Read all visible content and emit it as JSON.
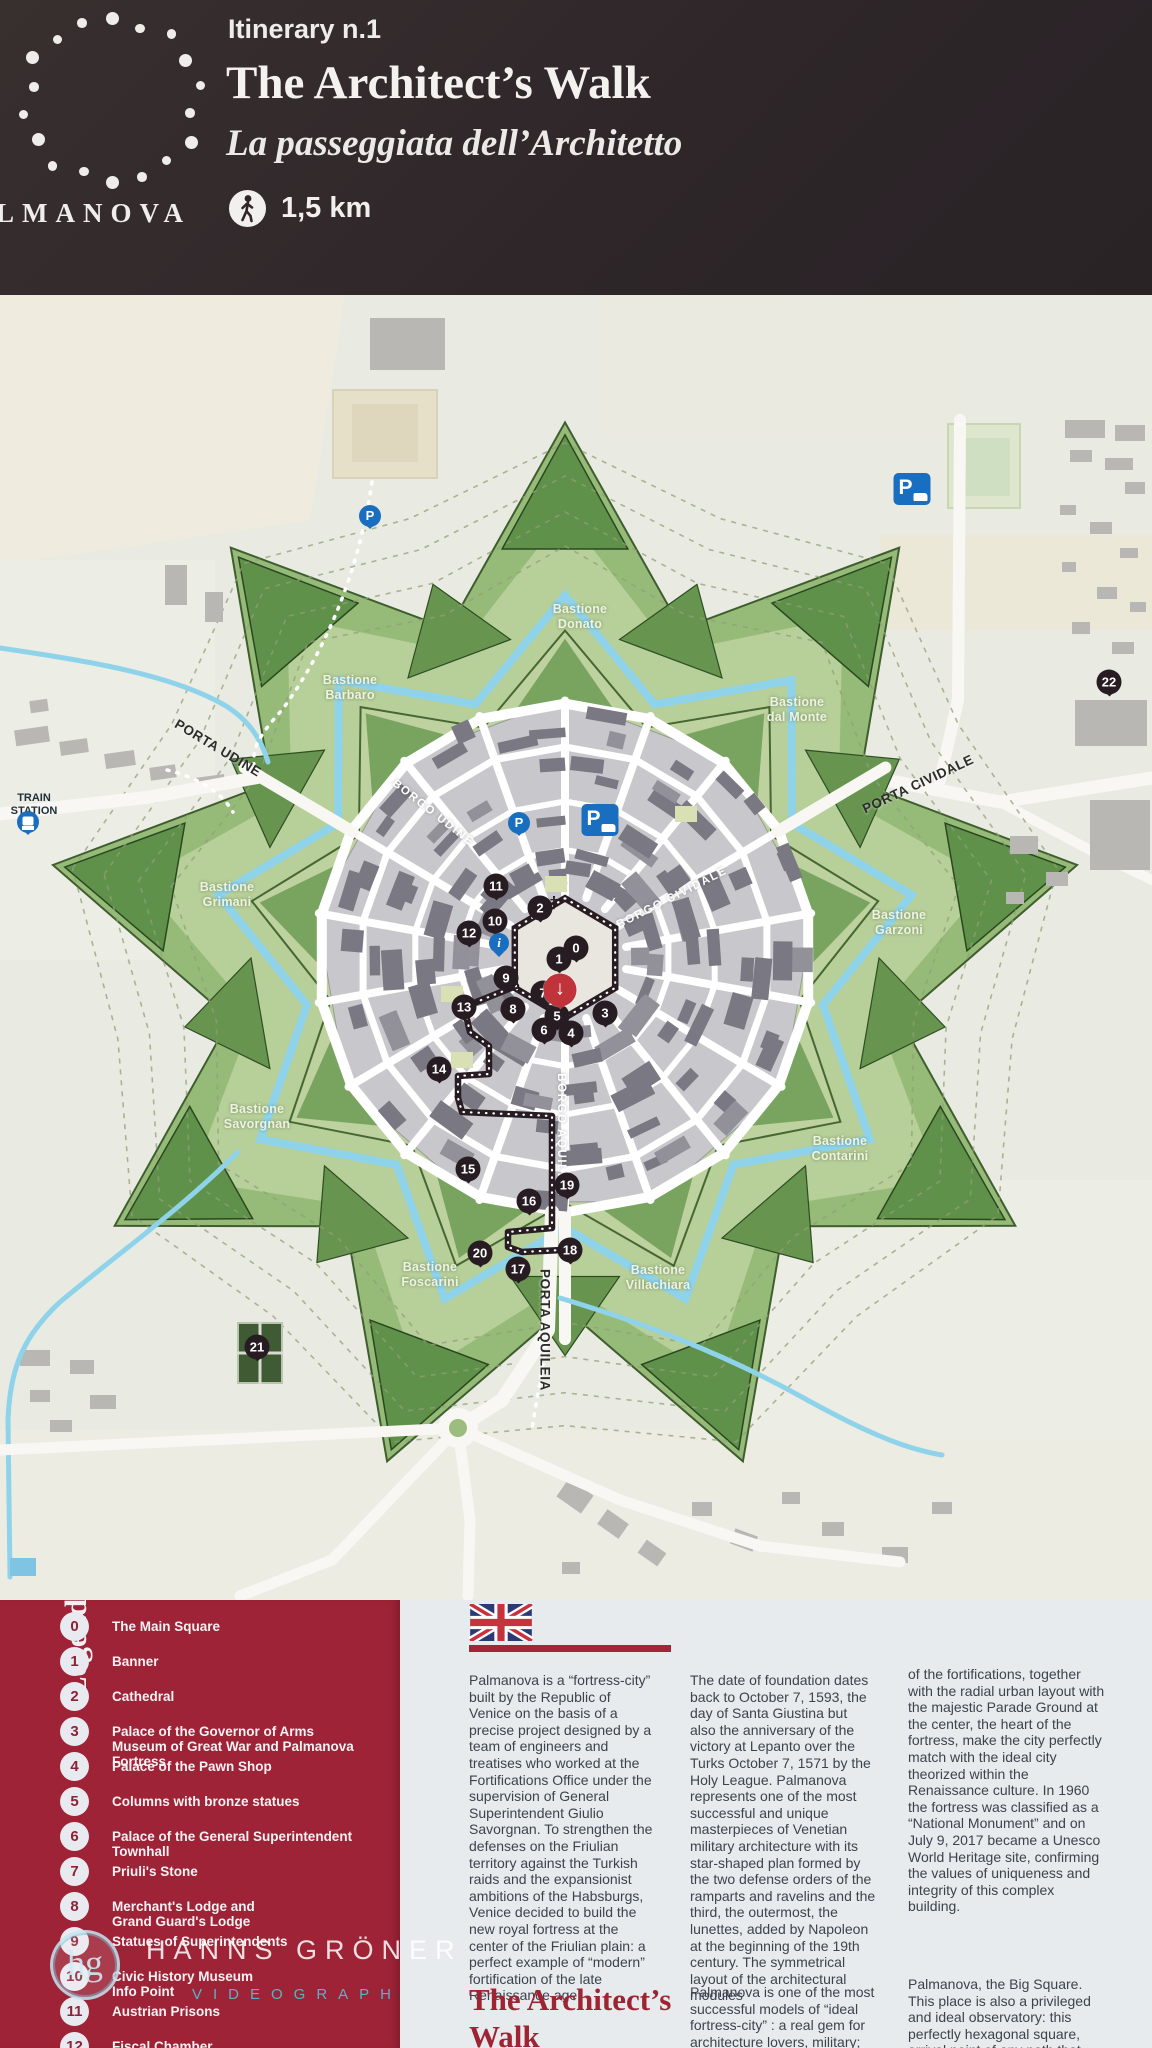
{
  "header": {
    "itinerary": "Itinerary n.1",
    "title": "The Architect’s Walk",
    "subtitle": "La passeggiata dell’Architetto",
    "distance": "1,5 km",
    "brand": "LMANOVA"
  },
  "map": {
    "train_station": "TRAIN\nSTATION",
    "bastions": [
      {
        "label": "Bastione\nDonato",
        "x": 580,
        "y": 617
      },
      {
        "label": "Bastione\nBarbaro",
        "x": 350,
        "y": 688
      },
      {
        "label": "Bastione\ndal Monte",
        "x": 797,
        "y": 710
      },
      {
        "label": "Bastione\nGrimani",
        "x": 227,
        "y": 895
      },
      {
        "label": "Bastione\nGarzoni",
        "x": 899,
        "y": 923
      },
      {
        "label": "Bastione\nSavorgnan",
        "x": 257,
        "y": 1117
      },
      {
        "label": "Bastione\nContarini",
        "x": 840,
        "y": 1149
      },
      {
        "label": "Bastione\nFoscarini",
        "x": 430,
        "y": 1275
      },
      {
        "label": "Bastione\nVillachiara",
        "x": 658,
        "y": 1278
      }
    ],
    "gates": [
      {
        "label": "PORTA UDINE",
        "x": 218,
        "y": 748,
        "rot": 31
      },
      {
        "label": "PORTA CIVIDALE",
        "x": 918,
        "y": 784,
        "rot": -25
      },
      {
        "label": "PORTA AQUILEIA",
        "x": 545,
        "y": 1330,
        "rot": 90
      }
    ],
    "streets": [
      {
        "label": "BORGO UDINE",
        "x": 433,
        "y": 813,
        "rot": 38
      },
      {
        "label": "BORGO CIVIDALE",
        "x": 672,
        "y": 898,
        "rot": -27
      },
      {
        "label": "BORGO AQUILEIA",
        "x": 561,
        "y": 1135,
        "rot": 90
      }
    ],
    "markers": [
      {
        "id": "0",
        "type": "num",
        "x": 576,
        "y": 948
      },
      {
        "id": "1",
        "type": "num",
        "x": 559,
        "y": 959
      },
      {
        "id": "2",
        "type": "num",
        "x": 540,
        "y": 908
      },
      {
        "id": "3",
        "type": "num",
        "x": 605,
        "y": 1013
      },
      {
        "id": "4",
        "type": "num",
        "x": 571,
        "y": 1033
      },
      {
        "id": "5",
        "type": "num",
        "x": 557,
        "y": 1016
      },
      {
        "id": "6",
        "type": "num",
        "x": 544,
        "y": 1030
      },
      {
        "id": "7",
        "type": "num",
        "x": 543,
        "y": 993
      },
      {
        "id": "8",
        "type": "num",
        "x": 513,
        "y": 1009
      },
      {
        "id": "9",
        "type": "num",
        "x": 506,
        "y": 978
      },
      {
        "id": "10",
        "type": "num",
        "x": 495,
        "y": 921
      },
      {
        "id": "11",
        "type": "num",
        "x": 496,
        "y": 886
      },
      {
        "id": "12",
        "type": "num",
        "x": 469,
        "y": 933
      },
      {
        "id": "13",
        "type": "num",
        "x": 464,
        "y": 1007
      },
      {
        "id": "14",
        "type": "num",
        "x": 439,
        "y": 1069
      },
      {
        "id": "15",
        "type": "num",
        "x": 468,
        "y": 1169
      },
      {
        "id": "16",
        "type": "num",
        "x": 529,
        "y": 1201
      },
      {
        "id": "17",
        "type": "num",
        "x": 518,
        "y": 1269
      },
      {
        "id": "18",
        "type": "num",
        "x": 570,
        "y": 1250
      },
      {
        "id": "19",
        "type": "num",
        "x": 567,
        "y": 1185
      },
      {
        "id": "20",
        "type": "num",
        "x": 480,
        "y": 1253
      },
      {
        "id": "21",
        "type": "num",
        "x": 257,
        "y": 1347
      },
      {
        "id": "22",
        "type": "num",
        "x": 1109,
        "y": 682
      },
      {
        "id": "P",
        "type": "p-circle",
        "x": 370,
        "y": 516
      },
      {
        "id": "P",
        "type": "p-sign",
        "x": 912,
        "y": 489
      },
      {
        "id": "P",
        "type": "p-circle",
        "x": 519,
        "y": 823
      },
      {
        "id": "P",
        "type": "p-sign",
        "x": 600,
        "y": 820
      },
      {
        "id": "i",
        "type": "info",
        "x": 499,
        "y": 943
      },
      {
        "id": "↓",
        "type": "here",
        "x": 560,
        "y": 990
      },
      {
        "id": "",
        "type": "train",
        "x": 28,
        "y": 822
      },
      {
        "id": "†",
        "type": "cross",
        "x": 554,
        "y": 903
      }
    ],
    "scale": {
      "values": [
        "0",
        "100",
        "200",
        "300",
        "400"
      ]
    }
  },
  "legend": {
    "title": "Legend",
    "items": [
      {
        "num": "0",
        "label": "The Main Square"
      },
      {
        "num": "1",
        "label": "Banner"
      },
      {
        "num": "2",
        "label": "Cathedral"
      },
      {
        "num": "3",
        "label": "Palace of the Governor of Arms\nMuseum of Great War and Palmanova Fortress"
      },
      {
        "num": "4",
        "label": "Palace of the Pawn Shop"
      },
      {
        "num": "5",
        "label": "Columns with bronze statues"
      },
      {
        "num": "6",
        "label": "Palace of the General Superintendent\nTownhall"
      },
      {
        "num": "7",
        "label": "Priuli's Stone"
      },
      {
        "num": "8",
        "label": "Merchant's Lodge and\nGrand Guard's Lodge"
      },
      {
        "num": "9",
        "label": "Statues of Superintendents"
      },
      {
        "num": "10",
        "label": "Civic History Museum\nInfo Point"
      },
      {
        "num": "11",
        "label": "Austrian Prisons"
      },
      {
        "num": "12",
        "label": "Fiscal Chamber"
      }
    ]
  },
  "info": {
    "col1": "Palmanova is a “fortress-city” built by the Republic of Venice on the basis of a precise project designed by a team of engineers and treatises who worked at the Fortifications Office under the supervision of General Superintendent Giulio Savorgnan. To strengthen the defenses on the Friulian territory against the Turkish raids and the expansionist ambitions of the Habsburgs, Venice decided to build the new royal fortress at the center of the Friulian plain: a perfect example of “modern” fortification of the late Renaissance age.",
    "heading": "The Architect’s Walk",
    "col2a": "The date of foundation dates back to October 7, 1593, the day of Santa Giustina but also the anniversary of the victory at Lepanto over the Turks October 7, 1571 by the Holy League. Palmanova represents one of the most successful and unique masterpieces of Venetian military architecture with its star-shaped plan formed by the two defense orders of the ramparts and ravelins and the third, the outermost, the lunettes, added by Napoleon at the beginning of the 19th century. The symmetrical layout of the architectural modules",
    "col2b": "Palmanova is one of the most successful models of “ideal fortress-city” : a real gem for architecture lovers, military; but not only. Its star-",
    "col3a": "of the fortifications, together with the radial urban layout with the majestic Parade Ground at the center, the heart of the fortress, make the city perfectly match with the ideal city theorized within the Renaissance culture. In 1960 the fortress was classified as a “National Monument” and on July 9, 2017 became a Unesco World Heritage site, confirming the values of uniqueness and integrity of this complex building.",
    "col3b": "Palmanova, the Big Square. This place is also a privileged and ideal observatory: this perfectly hexagonal square, arrival point of any path that starts from the"
  },
  "watermark": {
    "logo": "hg",
    "name": "HANNS GRÖNER",
    "sub": "VIDEOGRAPH"
  },
  "colors": {
    "header_bg": "#2e2629",
    "legend_red": "#9e2336",
    "accent_red": "#a32638",
    "glacis_green": "#96ba78",
    "dark_green": "#5f914b",
    "moat_blue": "#8fd3ea",
    "city_gray": "#c8c8cc",
    "building_gray": "#7a7983",
    "marker_dark": "#281c23",
    "parking_blue": "#1a6ec0",
    "here_red": "#c0333a"
  }
}
